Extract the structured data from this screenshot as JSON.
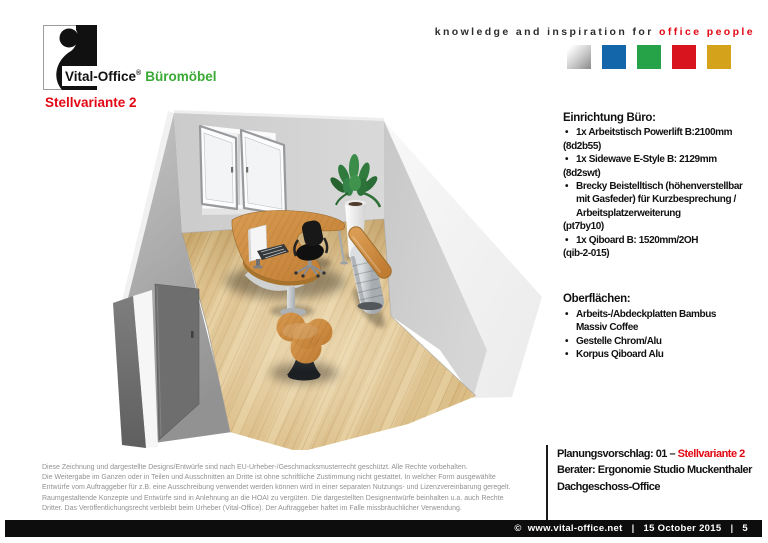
{
  "header": {
    "logo": {
      "brand": "Vital-Office",
      "registered": "®",
      "suffix": "Büromöbel"
    },
    "tagline": {
      "black": "knowledge and inspiration for",
      "red": "office people"
    },
    "color_squares": [
      "linear-gradient(135deg,#ffffff 10%,#c9c9c9 55%,#8a8a8a 100%)",
      "#1466ab",
      "#26a349",
      "#d8141f",
      "#d5a31b"
    ]
  },
  "page_title": "Stellvariante 2",
  "accent_red": "#e30613",
  "brand_green": "#3aaa35",
  "specs": {
    "title": "Einrichtung Büro:",
    "lines": [
      {
        "type": "bullet",
        "text": "1x Arbeitstisch Powerlift B:2100mm"
      },
      {
        "type": "code",
        "text": "(8d2b55)"
      },
      {
        "type": "bullet",
        "text": "1x Sidewave E-Style B: 2129mm"
      },
      {
        "type": "code",
        "text": "(8d2swt)"
      },
      {
        "type": "bullet",
        "text": "Brecky Beistelltisch (höhenverstellbar"
      },
      {
        "type": "cont",
        "text": "mit Gasfeder) für Kurzbesprechung /"
      },
      {
        "type": "cont",
        "text": "Arbeitsplatzerweiterung"
      },
      {
        "type": "code",
        "text": "(pt7by10)"
      },
      {
        "type": "bullet",
        "text": "1x Qiboard B: 1520mm/2OH"
      },
      {
        "type": "code",
        "text": "(qib-2-015)"
      }
    ]
  },
  "surfaces": {
    "title": "Oberflächen:",
    "lines": [
      {
        "type": "bullet",
        "text": "Arbeits-/Abdeckplatten Bambus"
      },
      {
        "type": "cont",
        "text": "Massiv  Coffee"
      },
      {
        "type": "bullet",
        "text": "Gestelle Chrom/Alu"
      },
      {
        "type": "bullet",
        "text": "Korpus Qiboard Alu"
      }
    ]
  },
  "proposal": {
    "prefix": "Planungsvorschlag: 01 – ",
    "highlight": "Stellvariante 2",
    "line2": "Berater: Ergonomie Studio Muckenthaler",
    "line3": "Dachgeschoss-Office"
  },
  "legal_lines": [
    "Diese Zeichnung und dargestellte Designs/Entwürfe sind nach EU-Urheber-/Geschmacksmusterrecht geschützt. Alle Rechte vorbehalten.",
    "Die Weitergabe im Ganzen oder in Teilen und Ausschnitten an Dritte ist ohne schriftliche Zustimmung nicht gestattet. In welcher Form ausgewählte",
    "Entwürfe vom Auftraggeber für z.B. eine Ausschreibung verwendet werden können wird in einer separaten Nutzungs- und Lizenzvereinbarung geregelt.",
    "Raumgestaltende Konzepte und Entwürfe sind in Anlehnung an die HOAI zu vergüten. Die dargestellten Designentwürfe beinhalten u.a. auch Rechte",
    "Dritter. Das Veröffentlichungsrecht verbleibt beim Urheber (Vital-Office). Der Auftraggeber haftet im Falle missbräuchlicher Verwendung."
  ],
  "footer": {
    "copyright": "©",
    "url": "www.vital-office.net",
    "separator": "|",
    "date": "15 October 2015",
    "page": "5"
  }
}
